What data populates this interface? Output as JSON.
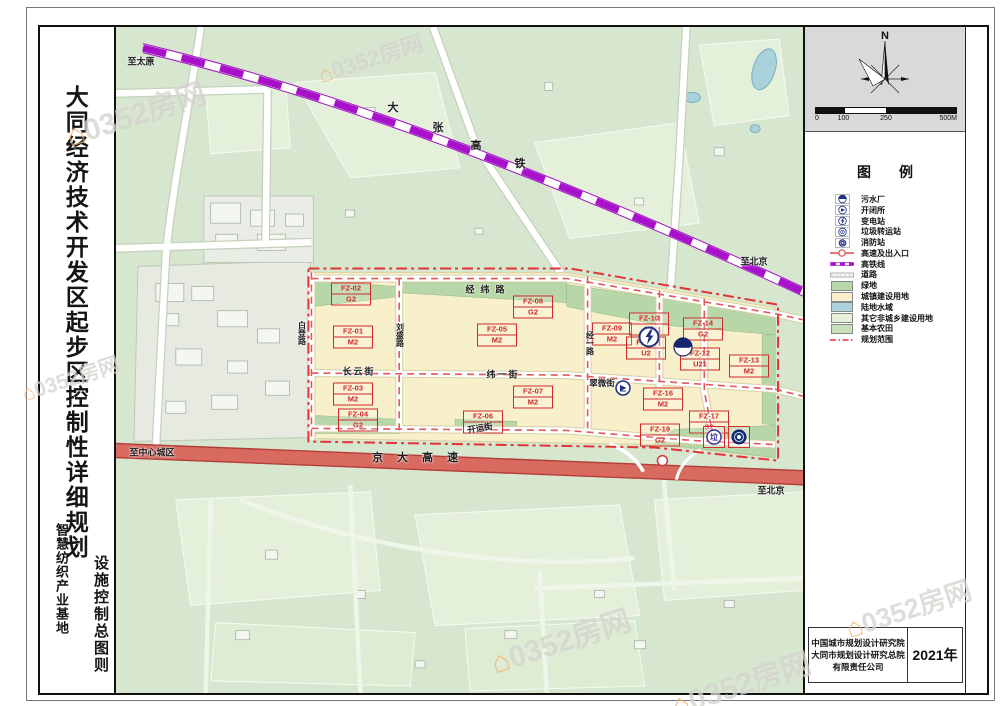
{
  "title": {
    "main": "大同经济技术开发区起步区控制性详细规划",
    "sub": "智慧纺织产业基地",
    "sheet": "设施控制总图则"
  },
  "north_label": "N",
  "scalebar": {
    "ticks": [
      "0",
      "100",
      "250",
      "500M"
    ]
  },
  "legend": {
    "title": "图　　例",
    "items": [
      {
        "icon": "sewage",
        "label": "污水厂"
      },
      {
        "icon": "switch",
        "label": "开闭所"
      },
      {
        "icon": "substation",
        "label": "变电站"
      },
      {
        "icon": "garbage",
        "label": "垃圾转运站"
      },
      {
        "icon": "fire",
        "label": "消防站"
      },
      {
        "icon": "highway",
        "label": "高速及出入口"
      },
      {
        "icon": "rail",
        "label": "高铁线"
      },
      {
        "icon": "road",
        "label": "道路"
      },
      {
        "icon": "fill",
        "color": "#b7d7a8",
        "label": "绿地"
      },
      {
        "icon": "fill",
        "color": "#f8f0cb",
        "label": "城镇建设用地"
      },
      {
        "icon": "fill",
        "color": "#a9d2dc",
        "label": "陆地水域"
      },
      {
        "icon": "fill",
        "color": "#e5f0db",
        "label": "其它非城乡建设用地"
      },
      {
        "icon": "fill",
        "color": "#c9e0bd",
        "label": "基本农田"
      },
      {
        "icon": "boundary",
        "label": "规划范围"
      }
    ]
  },
  "attribution": {
    "org_lines": [
      "中国城市规划设计研究院",
      "大同市规划设计研究总院",
      "有限责任公司"
    ],
    "year": "2021年"
  },
  "watermark": {
    "text": "0352房网"
  },
  "colors": {
    "map_bg": "#d7e6cf",
    "urban_land": "#f8f0cb",
    "green_space": "#b7d7a8",
    "water": "#a9d2dc",
    "other_land": "#e5f0db",
    "farmland": "#c9e0bd",
    "expressway_red": "#d96a60",
    "rail_purple": "#a611c9",
    "boundary_red": "#e23434",
    "parcel_red": "#cf2a2a",
    "facility_blue": "#1c2f86"
  },
  "map": {
    "parcels": [
      {
        "code": "FZ-02",
        "use": "G2",
        "x": 235,
        "y": 267
      },
      {
        "code": "FZ-01",
        "use": "M2",
        "x": 237,
        "y": 310
      },
      {
        "code": "FZ-03",
        "use": "M2",
        "x": 237,
        "y": 367
      },
      {
        "code": "FZ-04",
        "use": "G2",
        "x": 242,
        "y": 393
      },
      {
        "code": "FZ-05",
        "use": "M2",
        "x": 381,
        "y": 308
      },
      {
        "code": "FZ-06",
        "use": "G2",
        "x": 367,
        "y": 395
      },
      {
        "code": "FZ-07",
        "use": "M2",
        "x": 417,
        "y": 370
      },
      {
        "code": "FZ-08",
        "use": "G2",
        "x": 417,
        "y": 280
      },
      {
        "code": "FZ-09",
        "use": "M2",
        "x": 496,
        "y": 307
      },
      {
        "code": "FZ-10",
        "use": "U2",
        "x": 533,
        "y": 297
      },
      {
        "code": "FZ-11",
        "use": "U2",
        "x": 530,
        "y": 321
      },
      {
        "code": "FZ-12",
        "use": "U21",
        "x": 584,
        "y": 332
      },
      {
        "code": "FZ-13",
        "use": "M2",
        "x": 633,
        "y": 339
      },
      {
        "code": "FZ-14",
        "use": "G2",
        "x": 587,
        "y": 302
      },
      {
        "code": "FZ-16",
        "use": "M2",
        "x": 547,
        "y": 372
      },
      {
        "code": "FZ-17",
        "use": "S2",
        "x": 593,
        "y": 395
      },
      {
        "code": "FZ-19",
        "use": "G2",
        "x": 544,
        "y": 408
      }
    ],
    "facilities": [
      {
        "type": "substation",
        "x": 533,
        "y": 310
      },
      {
        "type": "sewage",
        "x": 567,
        "y": 320
      },
      {
        "type": "switch",
        "x": 507,
        "y": 361
      },
      {
        "type": "garbage",
        "x": 598,
        "y": 410,
        "boxed": true
      },
      {
        "type": "fire",
        "x": 623,
        "y": 410,
        "boxed": true
      }
    ],
    "labels": [
      {
        "text": "至太原",
        "x": 25,
        "y": 34,
        "size": 9
      },
      {
        "text": "大",
        "x": 277,
        "y": 80,
        "size": 11
      },
      {
        "text": "张",
        "x": 322,
        "y": 100,
        "size": 11
      },
      {
        "text": "高",
        "x": 360,
        "y": 118,
        "size": 11
      },
      {
        "text": "铁",
        "x": 404,
        "y": 136,
        "size": 11
      },
      {
        "text": "至北京",
        "x": 638,
        "y": 234,
        "size": 9
      },
      {
        "text": "经纬路",
        "x": 372,
        "y": 262,
        "size": 9,
        "spacing": 6
      },
      {
        "text": "长云街",
        "x": 243,
        "y": 344,
        "size": 9,
        "spacing": 2
      },
      {
        "text": "纬一街",
        "x": 387,
        "y": 347,
        "size": 9,
        "spacing": 2
      },
      {
        "text": "翠微街",
        "x": 486,
        "y": 356,
        "size": 8.5
      },
      {
        "text": "开运街",
        "x": 364,
        "y": 401,
        "size": 8.5,
        "rot": -9
      },
      {
        "text": "白登路",
        "x": 186,
        "y": 306,
        "size": 8,
        "vertical": true
      },
      {
        "text": "刘盛路",
        "x": 284,
        "y": 308,
        "size": 8,
        "vertical": true
      },
      {
        "text": "经一路",
        "x": 474,
        "y": 316,
        "size": 8,
        "vertical": true
      },
      {
        "text": "京大高速",
        "x": 306,
        "y": 430,
        "size": 11,
        "spacing": 14
      },
      {
        "text": "至中心城区",
        "x": 36,
        "y": 425,
        "size": 9
      },
      {
        "text": "至北京",
        "x": 655,
        "y": 463,
        "size": 9
      }
    ]
  },
  "watermarks": [
    {
      "x": 95,
      "y": 85,
      "s": 1
    },
    {
      "x": 330,
      "y": 30,
      "s": 0.75
    },
    {
      "x": 30,
      "y": 350,
      "s": 0.7
    },
    {
      "x": 520,
      "y": 612,
      "s": 1
    },
    {
      "x": 700,
      "y": 655,
      "s": 1
    },
    {
      "x": 868,
      "y": 580,
      "s": 0.9
    }
  ]
}
